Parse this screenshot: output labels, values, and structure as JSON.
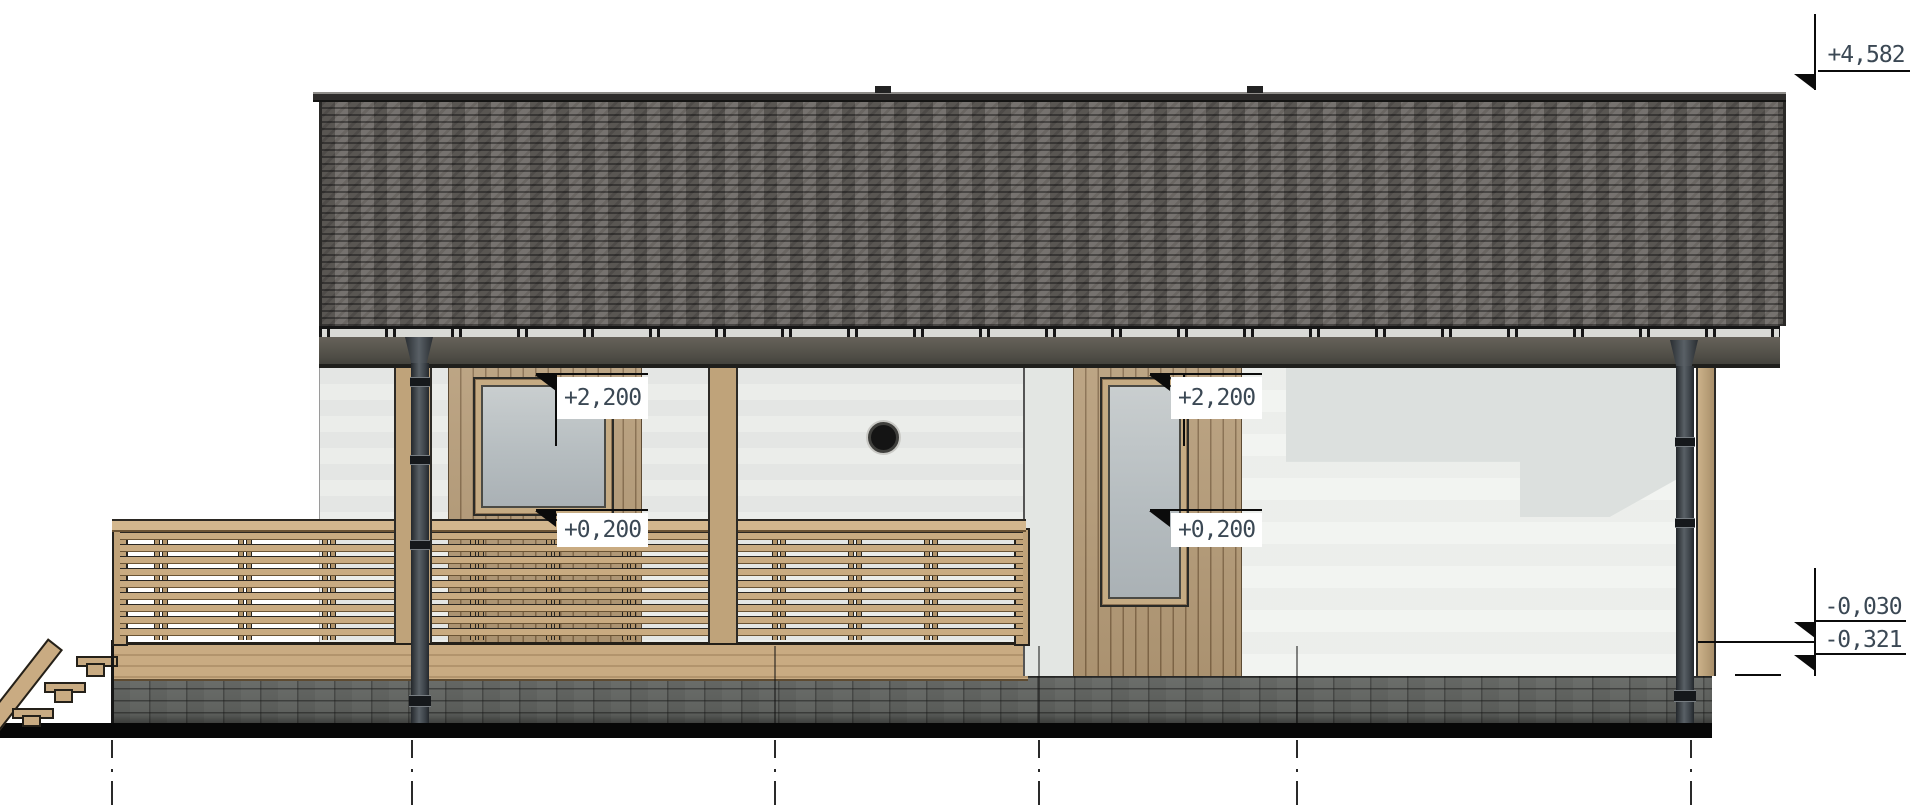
{
  "drawing": {
    "kind": "house side elevation",
    "elevation_markers": {
      "ridge": {
        "value": "+4,582"
      },
      "window_head_left": {
        "value": "+2,200"
      },
      "window_head_right": {
        "value": "+2,200"
      },
      "window_sill_left": {
        "value": "+0,200"
      },
      "window_sill_right": {
        "value": "+0,200"
      },
      "grade_upper": {
        "value": "-0,030"
      },
      "grade_lower": {
        "value": "-0,321"
      }
    },
    "colors": {
      "roof_shingles": "#6f6b67",
      "fascia": "#50504a",
      "wood_siding": "#b59b77",
      "deck_wood": "#c9ab82",
      "foundation_stone": "#9b9d9b",
      "window_glass": "#b9c0c3",
      "marker_text": "#3b4854",
      "ground_line": "#070707"
    }
  }
}
